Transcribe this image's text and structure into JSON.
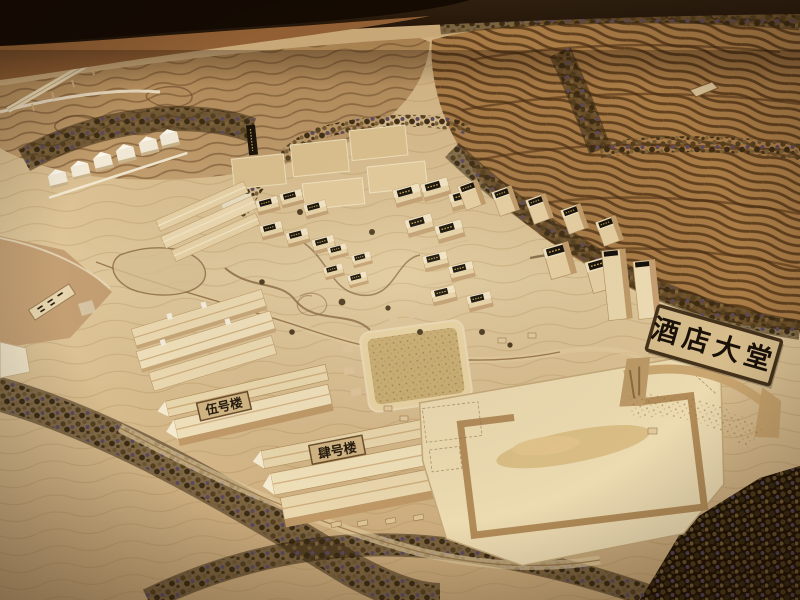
{
  "meta": {
    "description": "Photograph of a wooden architectural scale model of a hillside hotel resort: terraced contour slopes, tree belts, villa clusters, labelled buildings and a lobby arch sign",
    "kind": "photo-of-physical-model"
  },
  "signs": {
    "lobby_arch_label": "酒店大堂",
    "building_5_label": "伍号楼",
    "building_4_label": "肆号楼"
  },
  "palette": {
    "table_shadow": "#150b03",
    "wall_brown": "#2e1c0c",
    "floor_brown": "#915f33",
    "terrain_light": "#e0c99c",
    "terrain_mid": "#c9a878",
    "hill_tan": "#b58c5c",
    "terrace_base": "#aa7c46",
    "terrace_groove": "#503214",
    "tree_dark": "#3c2c14",
    "building_cream": "#ead7ac",
    "building_shadow": "#c19a68",
    "plaque_black": "#140f08",
    "plaque_gold": "#c8a243",
    "sign_board": "#d7bd8c",
    "sign_text": "#191008"
  }
}
